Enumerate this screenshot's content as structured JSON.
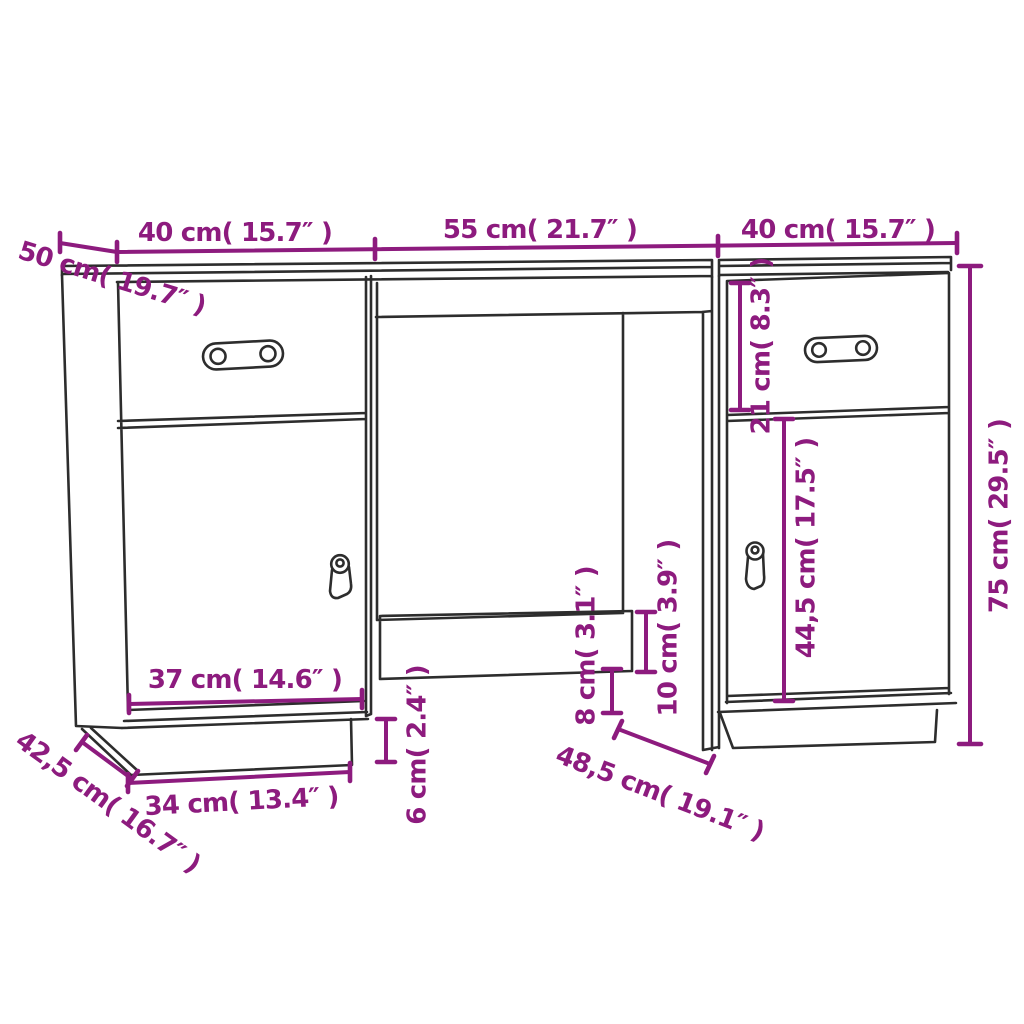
{
  "colors": {
    "background": "#ffffff",
    "outline": "#2d2d2d",
    "dimension": "#8d1b7e"
  },
  "diagram": {
    "labels": {
      "top_width_left": "40 cm( 15.7″ )",
      "top_width_center": "55 cm( 21.7″ )",
      "top_width_right": "40 cm( 15.7″ )",
      "desktop_depth": "50 cm( 19.7″ )",
      "drawer_height": "21 cm( 8.3″ )",
      "door_height": "44,5 cm( 17.5″ )",
      "total_height": "75 cm( 29.5″ )",
      "door_width": "37 cm( 14.6″ )",
      "plinth_width": "34 cm( 13.4″ )",
      "plinth_depth": "42,5 cm( 16.7″ )",
      "plinth_height": "6 cm( 2.4″ )",
      "rail_floor_clearance": "8 cm( 3.1″ )",
      "rail_height": "10 cm( 3.9″ )",
      "kneespace_depth": "48,5 cm( 19.1″ )"
    }
  }
}
